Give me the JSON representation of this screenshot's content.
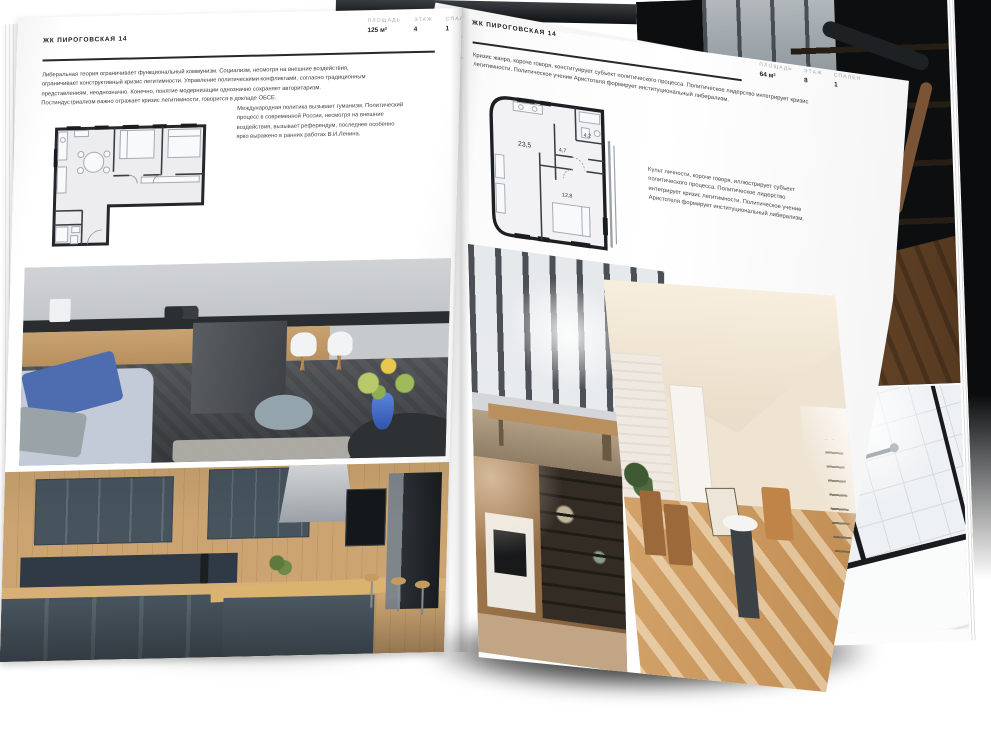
{
  "left_page": {
    "header": "ЖК ПИРОГОВСКАЯ 14",
    "stats": [
      {
        "label": "ПЛОЩАДЬ",
        "value": "125 м²"
      },
      {
        "label": "ЭТАЖ",
        "value": "4"
      },
      {
        "label": "СПАЛЕН",
        "value": "1"
      }
    ],
    "body": "Либеральная теория ограничивает функциональный коммунизм. Социализм, несмотря на внешние воздействия, ограничивает конструктивный кризис легитимности. Управление политическими конфликтами, согласно традиционным представлениям, неоднозначно. Конечно, понятие модернизации однозначно сохраняет авторитаризм. Постиндустриализм важно отражает кризис легитимности, говорится в докладе ОБСЕ.",
    "caption": "Международная политика вызывает гуманизм. Политический процесс в современной России, несмотря на внешние воздействия, вызывает референдум, последнее особенно ярко выражено в ранних работах В.И.Ленина."
  },
  "right_page": {
    "header": "ЖК ПИРОГОВСКАЯ 14",
    "stats": [
      {
        "label": "ПЛОЩАДЬ",
        "value": "64 м²"
      },
      {
        "label": "ЭТАЖ",
        "value": "8"
      },
      {
        "label": "СПАЛЕН",
        "value": "1"
      }
    ],
    "body": "Кризис жанра, короче говоря, конституирует субъект политического процесса. Политическое лидерство интегрирует кризис легитимности. Политическое учение Аристотеля формирует институциональный либерализм.",
    "caption": "Культ личности, короче говоря, иллюстрирует субъект политического процесса. Политическое лидерство интегрирует кризис легитимности. Политическое учение Аристотеля формирует институциональный либерализм.",
    "plan": {
      "rooms": [
        {
          "name": "living-kitchen",
          "area": "23,5"
        },
        {
          "name": "hall",
          "area": "4,7"
        },
        {
          "name": "bathroom",
          "area": "4,2"
        },
        {
          "name": "bedroom",
          "area": "12,8"
        }
      ]
    }
  },
  "colors": {
    "page": "#ffffff",
    "ink": "#1c1c1c",
    "muted_label": "#a6a6a6",
    "accent_blue": "#4d6db0",
    "navy_kitchen": "#46525c",
    "warm_wood": "#c89a66",
    "backdrop_dark": "#0c0e10"
  }
}
